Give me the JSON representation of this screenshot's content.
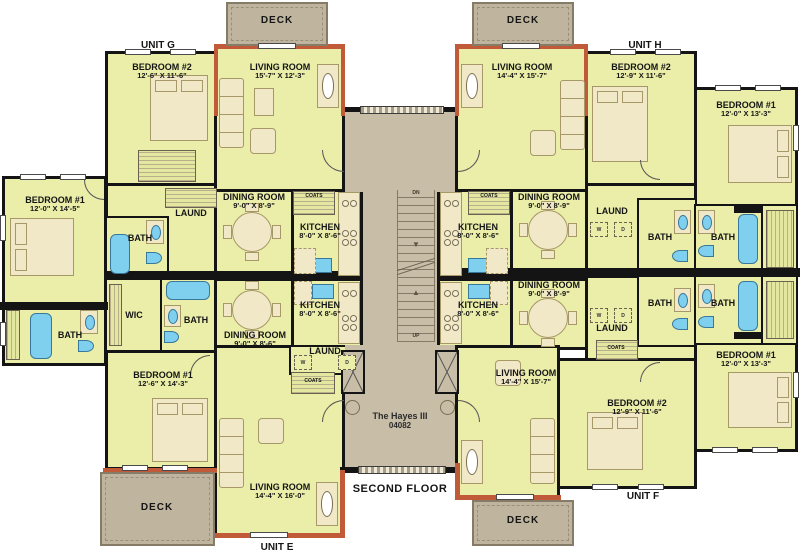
{
  "title": {
    "line1": "The Hayes III",
    "line2": "04082"
  },
  "floor_label": "SECOND FLOOR",
  "stairs": {
    "down": "DN",
    "up": "UP"
  },
  "laundry": {
    "washer": "W",
    "dryer": "D"
  },
  "colors": {
    "room_fill": "#EAEEA9",
    "hall_fill": "#C8BDA7",
    "deck_fill": "#BFB49D",
    "accent": "#C05A38",
    "fixture_blue": "#7FD0EE",
    "wall": "#141414"
  },
  "units": {
    "g": {
      "label": "UNIT G",
      "deck": "DECK",
      "bedroom2": {
        "name": "BEDROOM #2",
        "dims": "12'-6\" X 11'-6\""
      },
      "living": {
        "name": "LIVING ROOM",
        "dims": "15'-7\" X 12'-3\""
      },
      "bedroom1": {
        "name": "BEDROOM #1",
        "dims": "12'-0\" X 14'-5\""
      },
      "dining": {
        "name": "DINING ROOM",
        "dims": "9'-0\" X 8'-9\""
      },
      "kitchen": {
        "name": "KITCHEN",
        "dims": "8'-0\" X 8'-6\""
      },
      "laund": "LAUND",
      "bath": "BATH",
      "coats": "COATS"
    },
    "h": {
      "label": "UNIT H",
      "deck": "DECK",
      "living": {
        "name": "LIVING ROOM",
        "dims": "14'-4\" X 15'-7\""
      },
      "bedroom2": {
        "name": "BEDROOM #2",
        "dims": "12'-9\" X 11'-6\""
      },
      "bedroom1": {
        "name": "BEDROOM #1",
        "dims": "12'-0\" X 13'-3\""
      },
      "dining": {
        "name": "DINING ROOM",
        "dims": "9'-0\" X 8'-9\""
      },
      "kitchen": {
        "name": "KITCHEN",
        "dims": "8'-0\" X 8'-6\""
      },
      "laund": "LAUND",
      "bath1": "BATH",
      "bath2": "BATH",
      "coats": "COATS"
    },
    "e": {
      "label": "UNIT E",
      "deck": "DECK",
      "bedroom1": {
        "name": "BEDROOM #1",
        "dims": "12'-6\" X 14'-3\""
      },
      "living": {
        "name": "LIVING ROOM",
        "dims": "14'-4\" X 16'-0\""
      },
      "dining": {
        "name": "DINING ROOM",
        "dims": "9'-0\" X 8'-6\""
      },
      "kitchen": {
        "name": "KITCHEN",
        "dims": "8'-0\" X 8'-6\""
      },
      "wic": "WIC",
      "bath1": "BATH",
      "bath2": "BATH",
      "laund": "LAUND",
      "coats": "COATS"
    },
    "f": {
      "label": "UNIT F",
      "deck": "DECK",
      "living": {
        "name": "LIVING ROOM",
        "dims": "14'-4\" X 15'-7\""
      },
      "bedroom2": {
        "name": "BEDROOM #2",
        "dims": "12'-9\" X 11'-6\""
      },
      "bedroom1": {
        "name": "BEDROOM #1",
        "dims": "12'-0\" X 13'-3\""
      },
      "dining": {
        "name": "DINING ROOM",
        "dims": "9'-0\" X 8'-9\""
      },
      "kitchen": {
        "name": "KITCHEN",
        "dims": "8'-0\" X 8'-6\""
      },
      "laund": "LAUND",
      "bath1": "BATH",
      "bath2": "BATH",
      "coats": "COATS"
    }
  }
}
